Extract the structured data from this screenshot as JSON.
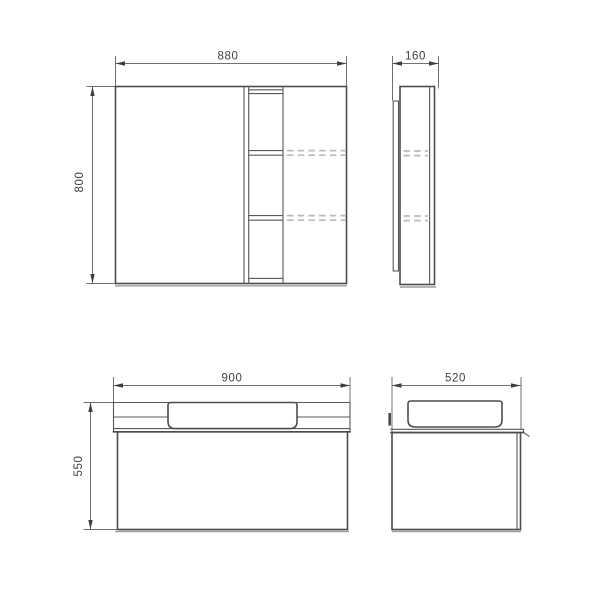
{
  "drawing": {
    "dimensions": {
      "mirror_front_width": "880",
      "mirror_front_height": "800",
      "mirror_side_depth": "160",
      "vanity_front_width": "900",
      "vanity_front_height": "550",
      "vanity_side_depth": "520"
    },
    "colors": {
      "background": "#ffffff",
      "object_line": "#4c4c4c",
      "dimension_line": "#707070",
      "hidden_line": "#bbbbbb",
      "label_text": "#3f3f3f"
    }
  }
}
